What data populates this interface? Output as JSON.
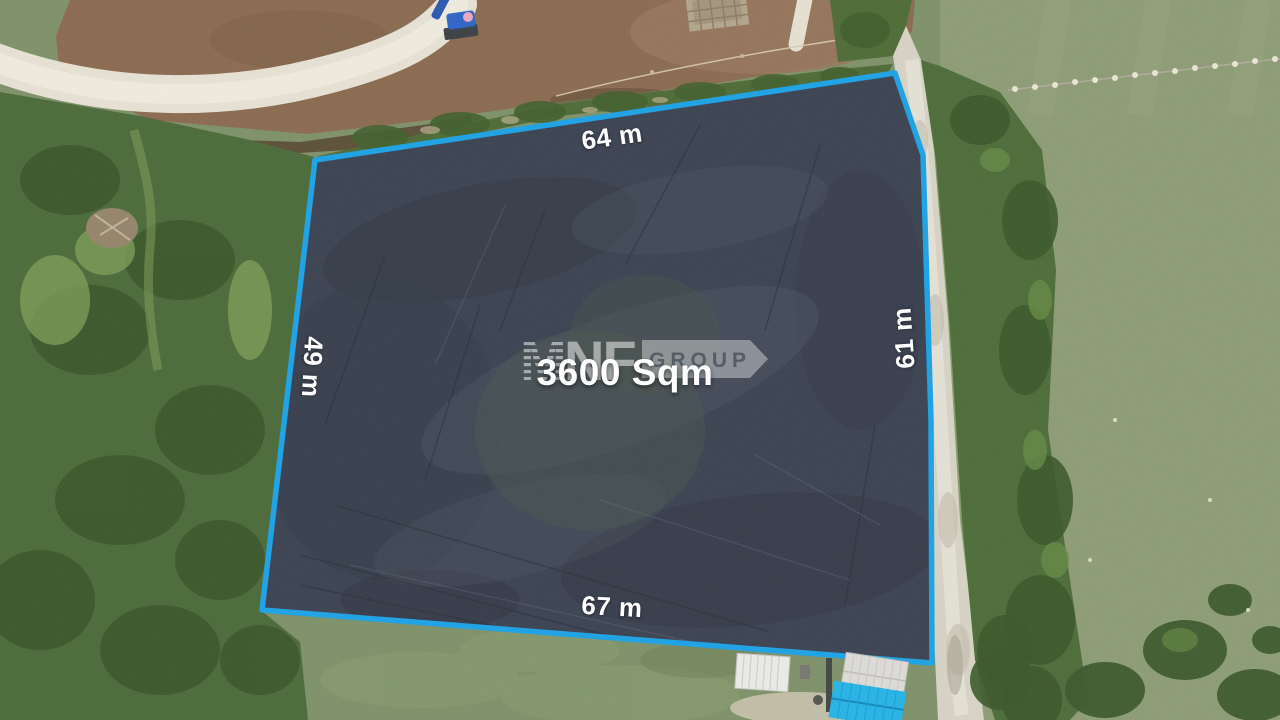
{
  "annotations": {
    "area": "3600 Sqm",
    "side_top": "64 m",
    "side_left": "49 m",
    "side_right": "61 m",
    "side_bottom": "67 m"
  },
  "watermark": {
    "part_m": "M",
    "part_nf": "NF",
    "part_group": "GROUP"
  },
  "colors": {
    "plot_outline": "#1ba2e6",
    "plot_fill": "#3a4150",
    "annotation_text": "#ffffff",
    "blue_roof": "#25b4e8"
  }
}
